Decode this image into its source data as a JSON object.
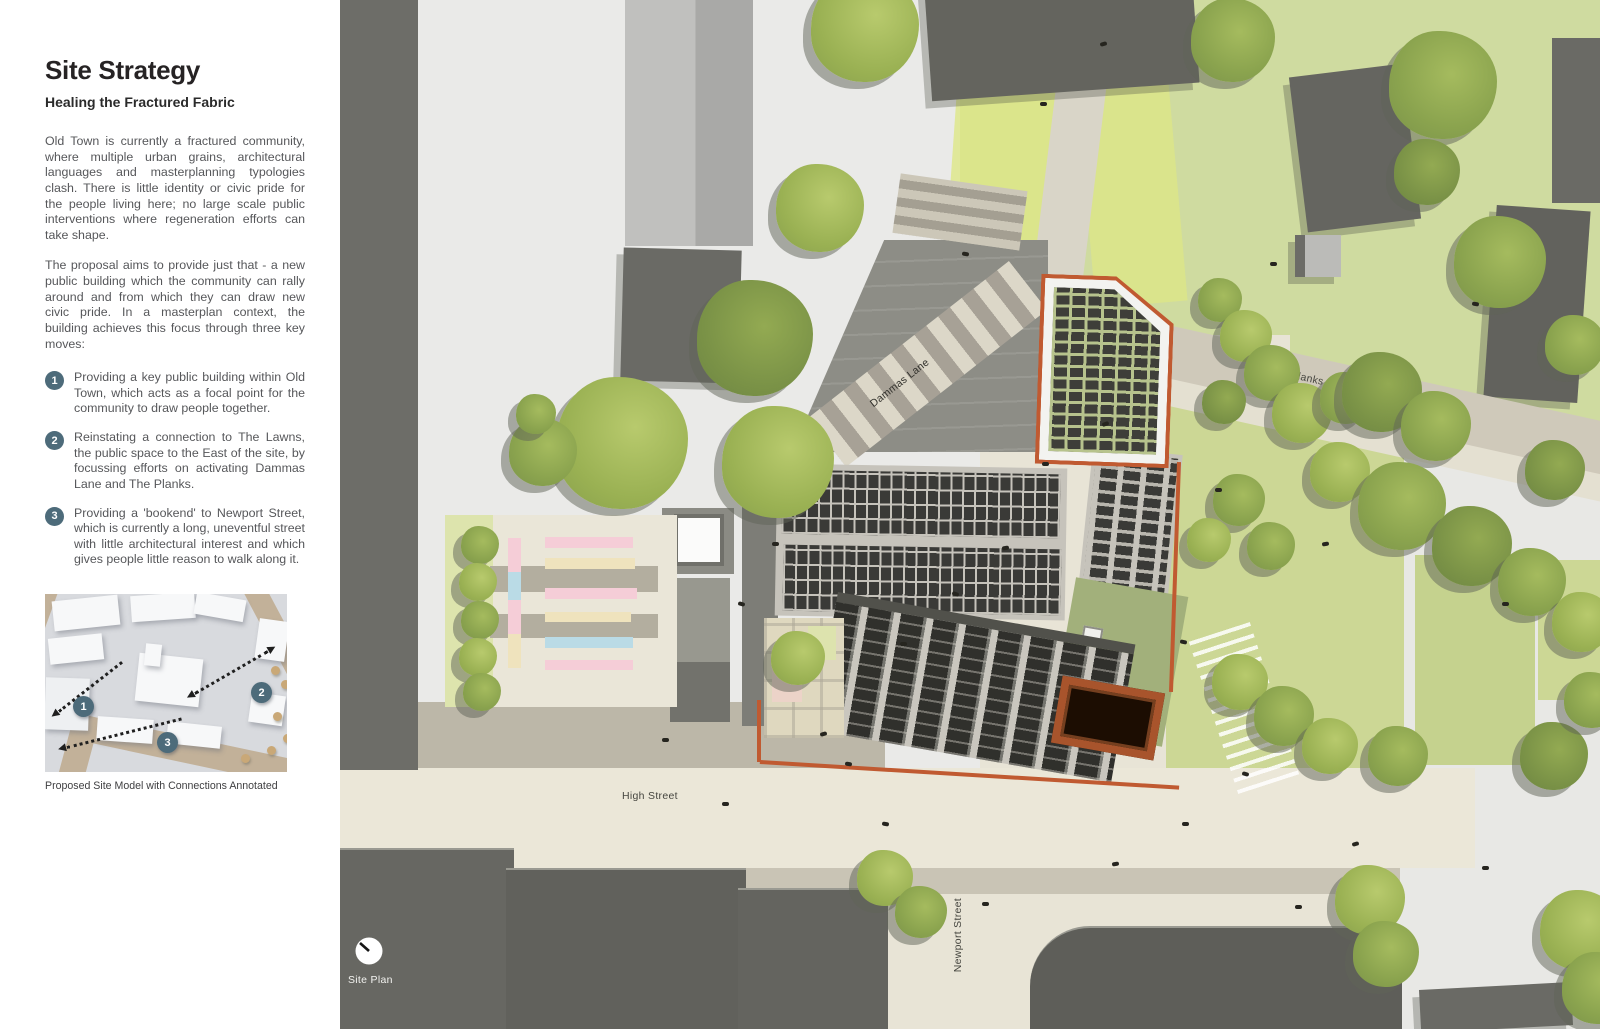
{
  "panel": {
    "title": "Site Strategy",
    "subtitle": "Healing the Fractured Fabric",
    "para1": "Old Town is currently a fractured community, where multiple urban grains, architectural languages and masterplanning typologies clash. There is little identity or civic pride for the people living here; no large scale public interventions where regeneration efforts can take shape.",
    "para2": "The proposal aims to provide just that - a new public building which the community can rally around and from which they can draw new civic pride. In a masterplan context, the building achieves this focus through three key moves:",
    "moves": [
      {
        "num": "1",
        "text": "Providing a key public building within Old Town, which acts as a focal point for the community to draw people together."
      },
      {
        "num": "2",
        "text": "Reinstating a connection to The Lawns, the public space to the East of the site, by focussing efforts on activating Dammas Lane and The Planks."
      },
      {
        "num": "3",
        "text": "Providing a 'bookend' to Newport Street, which is currently a long, uneventful street with little architectural interest and which gives people little reason to walk along it."
      }
    ],
    "model_badges": [
      "1",
      "2",
      "3"
    ],
    "caption": "Proposed Site Model with Connections Annotated"
  },
  "map": {
    "labels": {
      "dammas_lane": "Dammas Lane",
      "the_planks": "The Planks",
      "high_street": "High Street",
      "newport_street": "Newport Street",
      "site_plan": "Site Plan"
    },
    "trees": [
      [
        525,
        28,
        54,
        0
      ],
      [
        893,
        40,
        42,
        1
      ],
      [
        1103,
        85,
        54,
        1
      ],
      [
        1087,
        172,
        33,
        2
      ],
      [
        1160,
        262,
        46,
        1
      ],
      [
        1235,
        345,
        30,
        1
      ],
      [
        480,
        208,
        44,
        0
      ],
      [
        282,
        443,
        66,
        0
      ],
      [
        203,
        452,
        34,
        1
      ],
      [
        196,
        414,
        20,
        1
      ],
      [
        415,
        338,
        58,
        2
      ],
      [
        438,
        462,
        56,
        0
      ],
      [
        880,
        300,
        22,
        1
      ],
      [
        906,
        336,
        26,
        0
      ],
      [
        932,
        373,
        28,
        1
      ],
      [
        884,
        402,
        22,
        2
      ],
      [
        962,
        413,
        30,
        0
      ],
      [
        1006,
        398,
        26,
        1
      ],
      [
        1042,
        392,
        40,
        2
      ],
      [
        1096,
        426,
        35,
        1
      ],
      [
        1000,
        472,
        30,
        0
      ],
      [
        1062,
        506,
        44,
        1
      ],
      [
        1132,
        546,
        40,
        2
      ],
      [
        1192,
        582,
        34,
        1
      ],
      [
        1242,
        622,
        30,
        0
      ],
      [
        1215,
        470,
        30,
        2
      ],
      [
        899,
        500,
        26,
        1
      ],
      [
        869,
        540,
        22,
        0
      ],
      [
        931,
        546,
        24,
        1
      ],
      [
        900,
        682,
        28,
        0
      ],
      [
        944,
        716,
        30,
        1
      ],
      [
        990,
        746,
        28,
        0
      ],
      [
        1058,
        756,
        30,
        1
      ],
      [
        1214,
        756,
        34,
        2
      ],
      [
        1252,
        700,
        28,
        1
      ],
      [
        545,
        878,
        28,
        0
      ],
      [
        581,
        912,
        26,
        1
      ],
      [
        1030,
        900,
        35,
        0
      ],
      [
        1046,
        954,
        33,
        1
      ],
      [
        140,
        545,
        19,
        1
      ],
      [
        138,
        582,
        19,
        0
      ],
      [
        140,
        620,
        19,
        1
      ],
      [
        138,
        657,
        19,
        0
      ],
      [
        142,
        692,
        19,
        1
      ],
      [
        458,
        658,
        27,
        0
      ],
      [
        1240,
        930,
        40,
        0
      ],
      [
        1258,
        988,
        36,
        1
      ]
    ],
    "people": [
      [
        480,
        732,
        -15
      ],
      [
        505,
        762,
        10
      ],
      [
        560,
        642,
        0
      ],
      [
        612,
        592,
        20
      ],
      [
        662,
        546,
        -10
      ],
      [
        432,
        542,
        0
      ],
      [
        398,
        602,
        15
      ],
      [
        702,
        462,
        0
      ],
      [
        762,
        422,
        -20
      ],
      [
        622,
        252,
        10
      ],
      [
        700,
        102,
        0
      ],
      [
        760,
        42,
        -15
      ],
      [
        930,
        262,
        0
      ],
      [
        1132,
        302,
        10
      ],
      [
        982,
        542,
        -10
      ],
      [
        1162,
        602,
        0
      ],
      [
        902,
        772,
        15
      ],
      [
        842,
        822,
        0
      ],
      [
        772,
        862,
        -10
      ],
      [
        642,
        902,
        0
      ],
      [
        542,
        822,
        10
      ],
      [
        382,
        802,
        0
      ],
      [
        1012,
        842,
        -15
      ],
      [
        1142,
        866,
        0
      ],
      [
        955,
        905,
        0
      ],
      [
        322,
        738,
        0
      ],
      [
        875,
        488,
        0
      ],
      [
        840,
        640,
        12
      ]
    ]
  },
  "colors": {
    "accent_orange": "#C05A31",
    "corten": "#A8542C",
    "badge_slate": "#4D6B7A",
    "tree_green": "#8FA751",
    "roof_panel_dark": "#3A3A37",
    "green_roof": "#B7C38D",
    "lawn_green": "#CFDBA0",
    "pavement_beige": "#E8E4D6",
    "building_gray": "#67675F",
    "stall_pink": "#F5CDD7",
    "stall_cream": "#EFE3BD",
    "stall_blue": "#BADBE6"
  }
}
